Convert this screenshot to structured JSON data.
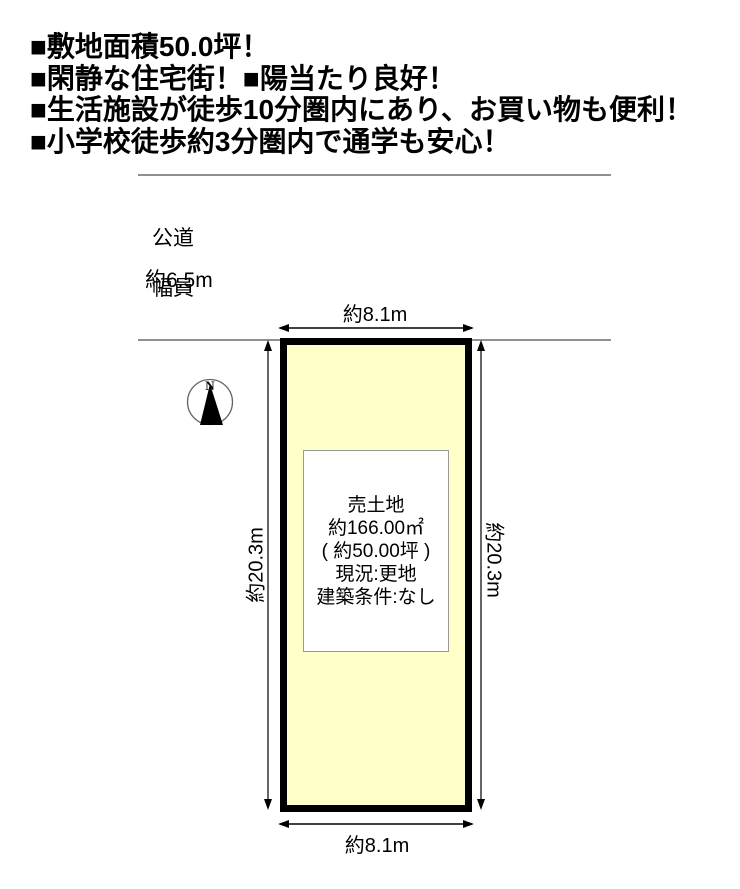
{
  "header": {
    "lines": [
      "■敷地面積50.0坪！",
      "■閑静な住宅街！■陽当たり良好！",
      "■生活施設が徒歩10分圏内にあり、お買い物も便利！",
      "■小学校徒歩約3分圏内で通学も安心！"
    ]
  },
  "road": {
    "name_label": "公道",
    "width_label": "幅員",
    "width_value": "約6.5m"
  },
  "compass": {
    "north_label": "N"
  },
  "plot": {
    "fill_color": "#FFFFC8",
    "border_color": "#000000",
    "width_top_label": "約8.1m",
    "width_bottom_label": "約8.1m",
    "depth_left_label": "約20.3m",
    "depth_right_label": "約20.3m"
  },
  "info_box": {
    "lines": [
      "売土地",
      "約166.00㎡",
      "( 約50.00坪 )",
      "現況:更地",
      "建築条件:なし"
    ]
  }
}
